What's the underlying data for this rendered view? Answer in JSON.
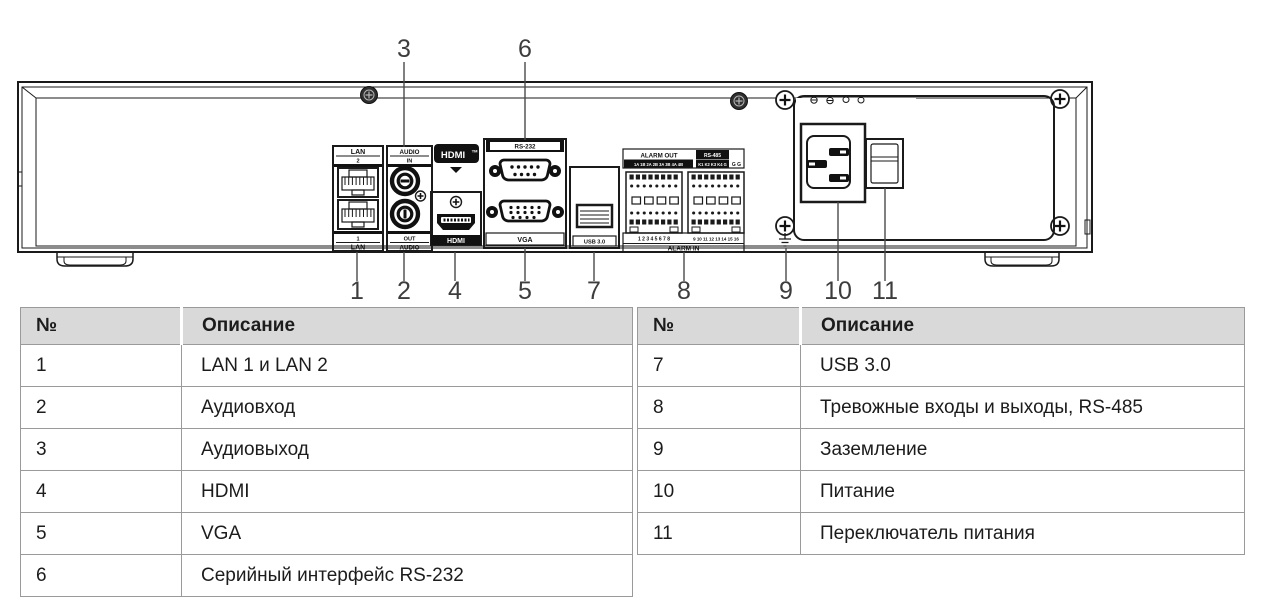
{
  "colors": {
    "ink": "#1a1a1a",
    "table_border": "#9a9a9a",
    "table_header_fill": "#d9d9d9",
    "callout_text": "#3d3d3d"
  },
  "diagram": {
    "labels": {
      "lan_top_line1": "LAN",
      "lan_top_line2": "2",
      "lan_bottom_line1": "1",
      "lan_bottom_line2": "LAN",
      "audio_top_line1": "AUDIO",
      "audio_top_line2": "IN",
      "audio_bottom_line1": "OUT",
      "audio_bottom_line2": "AUDIO",
      "hdmi_logo": "HDMI",
      "hdmi_logo_tm": "TM",
      "hdmi_port_label": "HDMI",
      "rs232_label": "RS-232",
      "vga_label": "VGA",
      "usb_label": "USB 3.0",
      "alarm_out_label": "ALARM OUT",
      "rs485_label": "RS-485",
      "alarm_out_pins": "1A 1B 2A 2B 3A 3B 4A 4B",
      "rs485_pins": "K1 K2 K3 K4 G",
      "ground_terminals": "G      G",
      "alarm_in_numbers_left": "1 2 3 4 5 6 7 8",
      "alarm_in_numbers_right": "9 10 11 12 13 14 15 16",
      "alarm_in_label": "ALARM IN"
    },
    "callouts": {
      "c1": "1",
      "c2": "2",
      "c3": "3",
      "c4": "4",
      "c5": "5",
      "c6": "6",
      "c7": "7",
      "c8": "8",
      "c9": "9",
      "c10": "10",
      "c11": "11"
    }
  },
  "tables": {
    "left": {
      "col_no": "№",
      "col_desc": "Описание",
      "rows": [
        [
          "1",
          "LAN 1 и LAN 2"
        ],
        [
          "2",
          "Аудиовход"
        ],
        [
          "3",
          "Аудиовыход"
        ],
        [
          "4",
          "HDMI"
        ],
        [
          "5",
          "VGA"
        ],
        [
          "6",
          "Серийный интерфейс RS-232"
        ]
      ]
    },
    "right": {
      "col_no": "№",
      "col_desc": "Описание",
      "rows": [
        [
          "7",
          "USB 3.0"
        ],
        [
          "8",
          "Тревожные входы и выходы, RS-485"
        ],
        [
          "9",
          "Заземление"
        ],
        [
          "10",
          "Питание"
        ],
        [
          "11",
          "Переключатель питания"
        ]
      ]
    }
  }
}
